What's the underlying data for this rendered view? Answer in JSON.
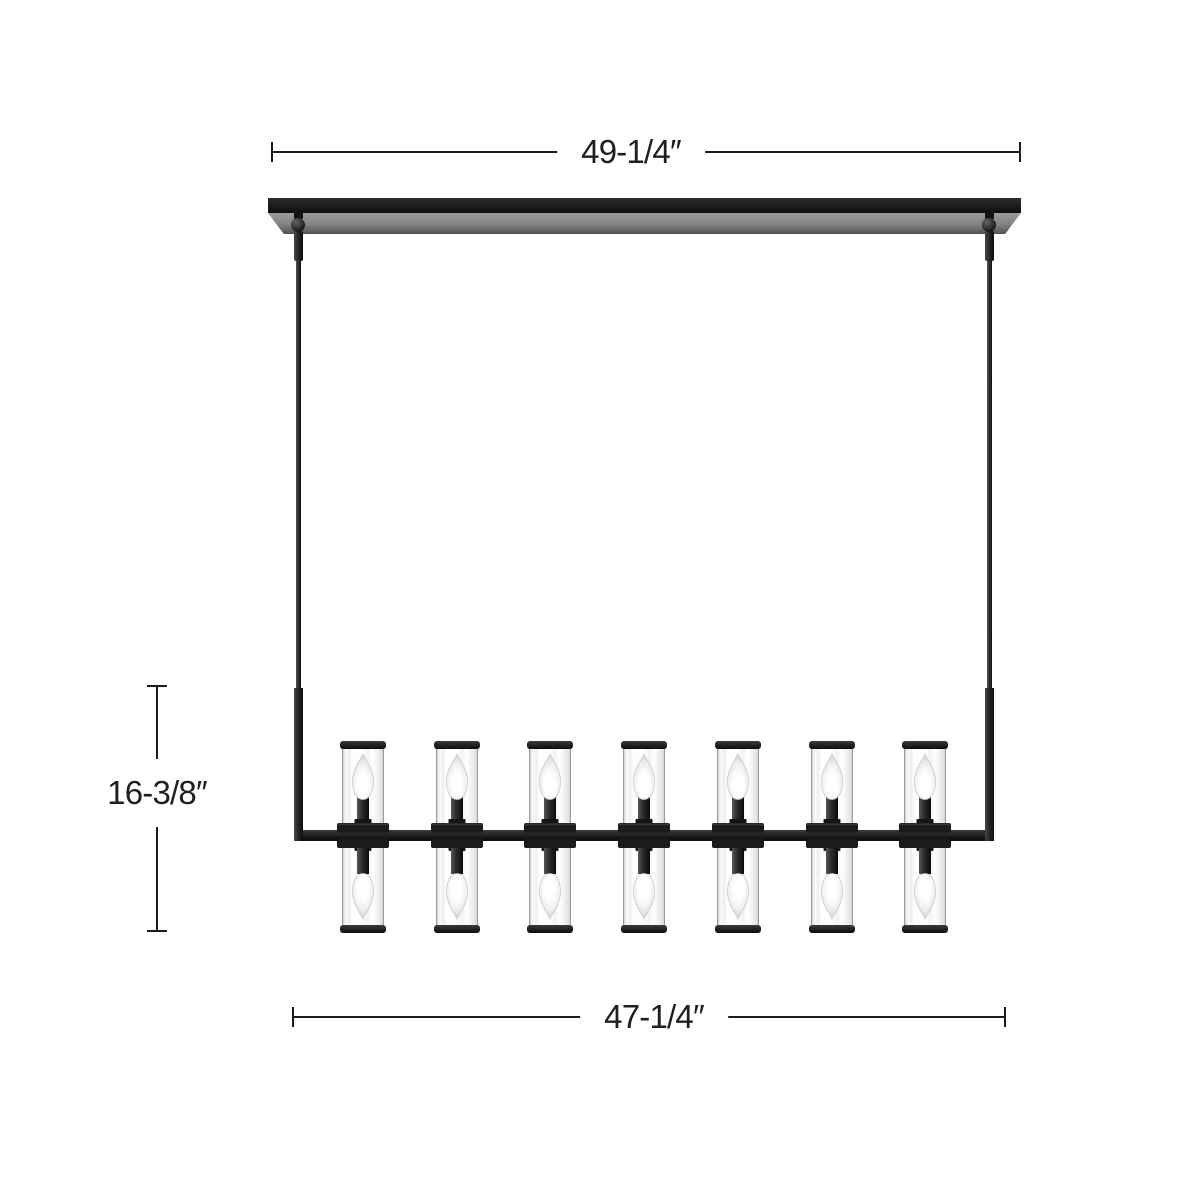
{
  "page": {
    "background": "#ffffff",
    "description": "Linear chandelier dimension diagram"
  },
  "dimensions": {
    "top": {
      "label": "49-1/4″"
    },
    "bottom": {
      "label": "47-1/4″"
    },
    "left": {
      "label": "16-3/8″"
    },
    "line_color": "#1c1c1c",
    "text_color": "#1f1f1f"
  },
  "fixture": {
    "type": "linear-chandelier",
    "columns": 7,
    "lights_per_column": 2,
    "total_lights": 14,
    "colors": {
      "metal_black": "#1b1b1b",
      "metal_highlight": "#4a4a4a",
      "canopy_face_gray": "#8c8c8c",
      "glass_edge": "#9a9a9a",
      "glass_fill": "#ffffff",
      "bulb_outline": "#c9c9c9",
      "bulb_glow": "#ffffff"
    }
  }
}
